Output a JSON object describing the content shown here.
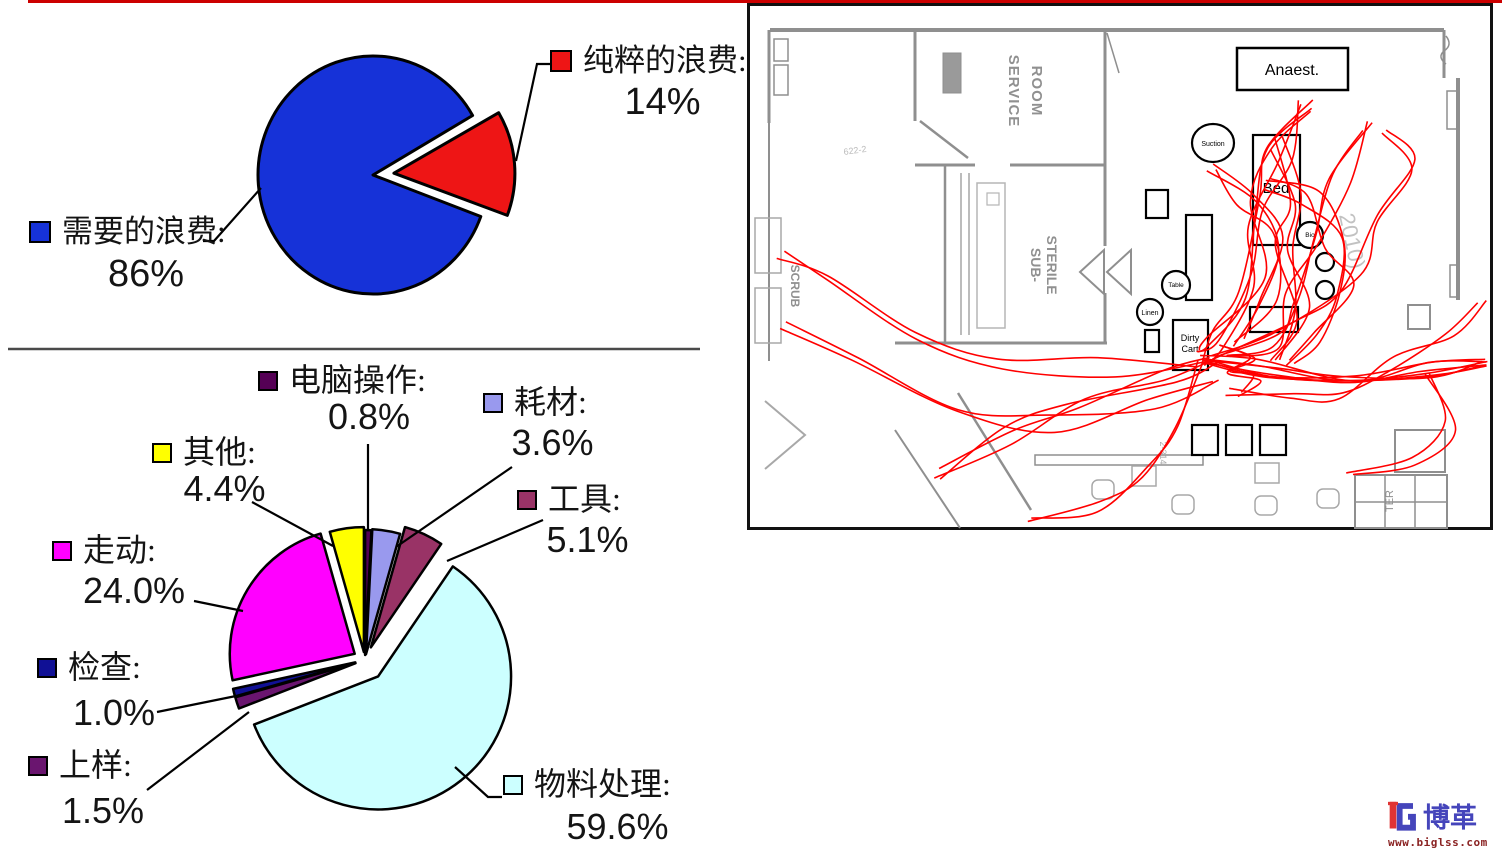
{
  "page": {
    "accent_color": "#cc0000",
    "background": "#ffffff"
  },
  "chart_data": [
    {
      "id": "waste-pie",
      "type": "pie",
      "unit": "percent",
      "legend_position": "callout",
      "slices": [
        {
          "label": "需要的浪费",
          "label_text": "需要的浪费:",
          "value": 86,
          "value_text": "86%",
          "color": "#1632d8"
        },
        {
          "label": "纯粹的浪费",
          "label_text": "纯粹的浪费:",
          "value": 14,
          "value_text": "14%",
          "color": "#ee1515"
        }
      ]
    },
    {
      "id": "activity-pie",
      "type": "pie",
      "unit": "percent",
      "legend_position": "callout",
      "slices": [
        {
          "label": "电脑操作",
          "label_text": "电脑操作:",
          "value": 0.8,
          "value_text": "0.8%",
          "color": "#550055"
        },
        {
          "label": "耗材",
          "label_text": "耗材:",
          "value": 3.6,
          "value_text": "3.6%",
          "color": "#9999ee"
        },
        {
          "label": "工具",
          "label_text": "工具:",
          "value": 5.1,
          "value_text": "5.1%",
          "color": "#993366"
        },
        {
          "label": "物料处理",
          "label_text": "物料处理:",
          "value": 59.6,
          "value_text": "59.6%",
          "color": "#ccffff"
        },
        {
          "label": "上样",
          "label_text": "上样:",
          "value": 1.5,
          "value_text": "1.5%",
          "color": "#6a156f"
        },
        {
          "label": "检查",
          "label_text": "检查:",
          "value": 1.0,
          "value_text": "1.0%",
          "color": "#101095"
        },
        {
          "label": "走动",
          "label_text": "走动:",
          "value": 24.0,
          "value_text": "24.0%",
          "color": "#ff00ff"
        },
        {
          "label": "其他",
          "label_text": "其他:",
          "value": 4.4,
          "value_text": "4.4%",
          "color": "#ffff00"
        }
      ]
    }
  ],
  "floor_plan": {
    "type": "spaghetti-diagram",
    "trace_color": "#ff0000",
    "labels": {
      "anaest": "Anaest.",
      "bed": "Bed",
      "suction": "Suction",
      "bio": "Bio",
      "table": "Table",
      "linen": "Linen",
      "dirty_line1": "Dirty",
      "dirty_line2": "Cart",
      "service_room_1": "SERVICE",
      "service_room_2": "ROOM",
      "sub_sterile_1": "SUB-",
      "sub_sterile_2": "STERILE",
      "scrub": "SCRUB",
      "shelf": "TER",
      "corridor": "2-314",
      "note": "622-2",
      "watermark": "2010)"
    }
  },
  "logo": {
    "brand": "博革",
    "url": "www.biglss.com"
  }
}
